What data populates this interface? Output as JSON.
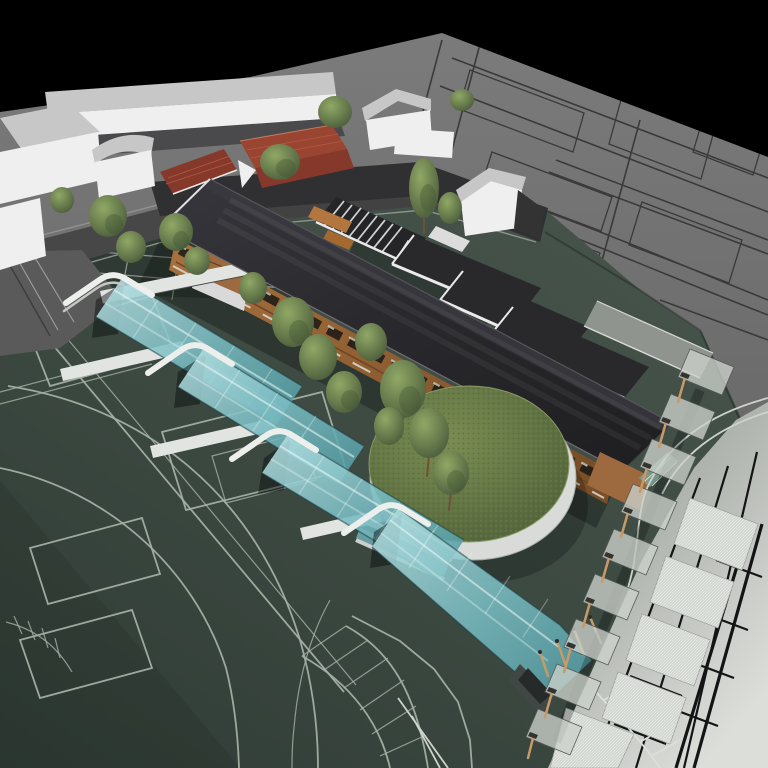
{
  "meta": {
    "title": "Aerial 3D architectural site rendering",
    "view": "axonometric bird's-eye",
    "contains_text": false
  },
  "palette": {
    "sky": "#000000",
    "plane_gray": "#6d6d6d",
    "cad_line": "#3a3a3a",
    "field_green": "#3c4941",
    "courtyard_green": "#2e3a33",
    "court_line": "#a7b2a7",
    "asphalt": "#474747",
    "white_wall": "#efefef",
    "gray_roof": "#c7c7c7",
    "red_roof": "#9a4432",
    "dark_roof": "#29292c",
    "wood_facade": "#9c6a3e",
    "teal_canopy": "#7fc0c6",
    "lawn_green": "#617244",
    "drum_white": "#d8dbd7",
    "canopy_panel": "#ccd1cb",
    "post_wood": "#c79a68",
    "walk_hatch": "#d2d7d1",
    "road_light": "#c9ccc8",
    "road_line_black": "#141414",
    "tree_green": "#5d7046",
    "shadow": "#1a1d1b"
  },
  "scene": {
    "objects": [
      {
        "name": "sky",
        "desc": "black background above tilted site plane"
      },
      {
        "name": "cad-ground-plane",
        "desc": "gray plane upper right with dark building-footprint linework and curved road"
      },
      {
        "name": "context-buildings",
        "desc": "white existing buildings with gray roofs along the top left, two with red tiled gable roofs"
      },
      {
        "name": "main-building",
        "desc": "long linear school building, large dark mono-pitch roof, timber slat facade with window bands"
      },
      {
        "name": "outdoor-stairs",
        "desc": "wide exterior stair with light treads beside the roof"
      },
      {
        "name": "glass-atrium",
        "desc": "small green glazed courtyard box next to stairs"
      },
      {
        "name": "annex-pavilions",
        "desc": "three flat dark roofs with white fascias stepping down to the right"
      },
      {
        "name": "circular-green-roof",
        "desc": "round grass roof on a white cylindrical drum at the building end"
      },
      {
        "name": "entrance-ramps",
        "desc": "four cascading translucent teal glass ramp canopies with curved white head walls"
      },
      {
        "name": "sports-field",
        "desc": "dark green field with pale court rectangles, running-track arcs and curved ladder crossings"
      },
      {
        "name": "canopy-walkway",
        "desc": "row of translucent panels on timber posts running down the right side"
      },
      {
        "name": "hatched-walkways",
        "desc": "light hatched pedestrian strips near lower right"
      },
      {
        "name": "parking-road",
        "desc": "light gray road bottom right with black CAD parking bays"
      },
      {
        "name": "trees",
        "desc": "about eighteen green trees around courtyards and along the facade"
      }
    ]
  }
}
